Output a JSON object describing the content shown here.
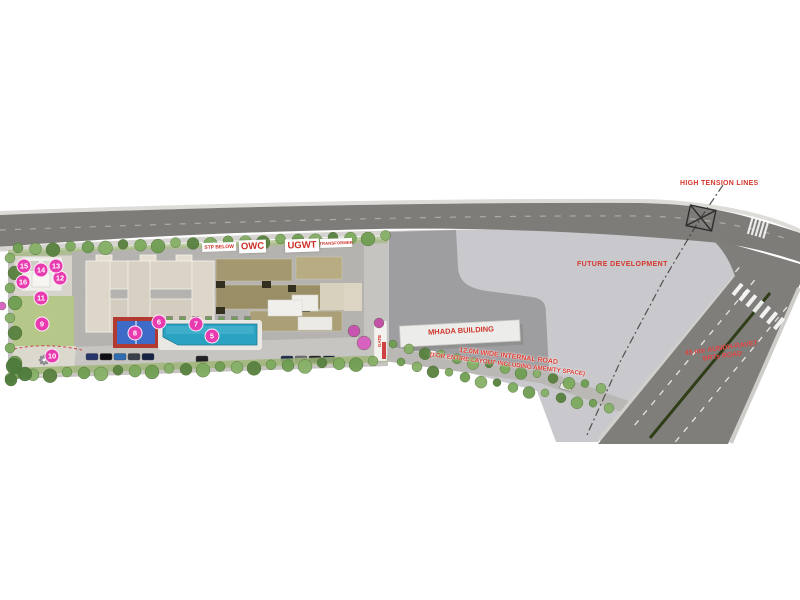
{
  "labels": {
    "high_tension_lines": "HIGH TENSION LINES",
    "future_development": "FUTURE DEVELOPMENT",
    "mhada_building": "MHADA BUILDING",
    "stp_below": "STP BELOW",
    "owc": "OWC",
    "ugwt": "UGWT",
    "transformer": "TRANSFORMER",
    "internal_road_line1": "12.0M WIDE INTERNAL ROAD",
    "internal_road_line2": "(FOR ENTIRE LAYOUT INCLUDING AMENITY SPACE)",
    "brts_road_line1": "45 mtr AUNDH-RAVET",
    "brts_road_line2": "BRTs ROAD",
    "gate": "GATE"
  },
  "markers": [
    {
      "number": "5",
      "x": 212,
      "y": 336
    },
    {
      "number": "6",
      "x": 159,
      "y": 322
    },
    {
      "number": "7",
      "x": 196,
      "y": 324
    },
    {
      "number": "8",
      "x": 135,
      "y": 333
    },
    {
      "number": "9",
      "x": 42,
      "y": 324
    },
    {
      "number": "10",
      "x": 52,
      "y": 356
    },
    {
      "number": "11",
      "x": 41,
      "y": 298
    },
    {
      "number": "12",
      "x": 60,
      "y": 278
    },
    {
      "number": "13",
      "x": 56,
      "y": 266
    },
    {
      "number": "14",
      "x": 41,
      "y": 270
    },
    {
      "number": "15",
      "x": 24,
      "y": 266
    },
    {
      "number": "16",
      "x": 23,
      "y": 282
    }
  ],
  "palette": {
    "road_gray": "#7e7c78",
    "future_development_gray": "#c9c9cd",
    "mhada_plot_gray": "#9e9ea0",
    "pool_cyan": "#2aa3c2",
    "court_blue": "#3e6bc8",
    "court_red": "#b23a30",
    "marker_pink": "#e83bb0",
    "label_red": "#d4372c",
    "lawn_green": "#b6c889",
    "tree_green": "#6f9e52",
    "building_beige": "#dbd4c6",
    "building_khaki": "#a49871"
  }
}
